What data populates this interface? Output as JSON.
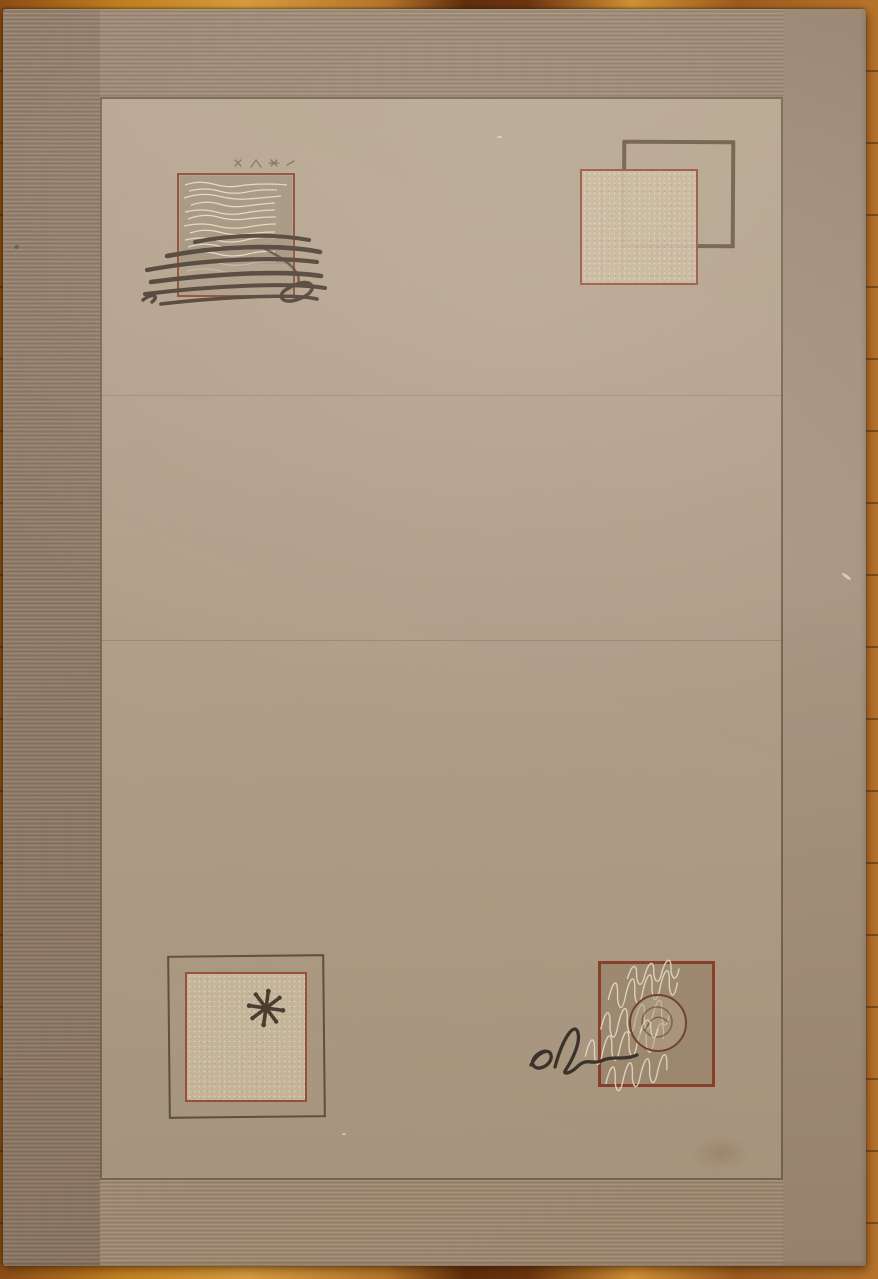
{
  "scene": {
    "subject": "beige ribbed area rug with abstract square motifs lying on an orange wood floor"
  },
  "palette": {
    "wood_floor": "#a55d1d",
    "rug_field": "#b3a18a",
    "rug_border_left": "#8a7662",
    "rug_border_top": "#95826c",
    "rug_border_right": "#a4907a",
    "rug_border_bottom": "#a38d75",
    "inner_outline": "#62533f",
    "red_outline": "#9c5140",
    "dark_square_outline": "#6d5b45",
    "cream_fill": "#cabb9e",
    "taupe_fill": "#a28f75",
    "scribble_dark": "#4a3e31",
    "thread_white": "#efe6d2",
    "signature_ink": "#37302a"
  },
  "motifs": {
    "top_left": {
      "name": "red-outlined square with white thread hatching and dark scribble strokes"
    },
    "top_right": {
      "name": "dark open square overlapped by cream sparkle square with red outline"
    },
    "bottom_left": {
      "name": "dark framed cream square containing a dark asterisk"
    },
    "bottom_right": {
      "name": "red-outlined taupe square with white loop scribbles, central circle and cursive el signature"
    }
  }
}
